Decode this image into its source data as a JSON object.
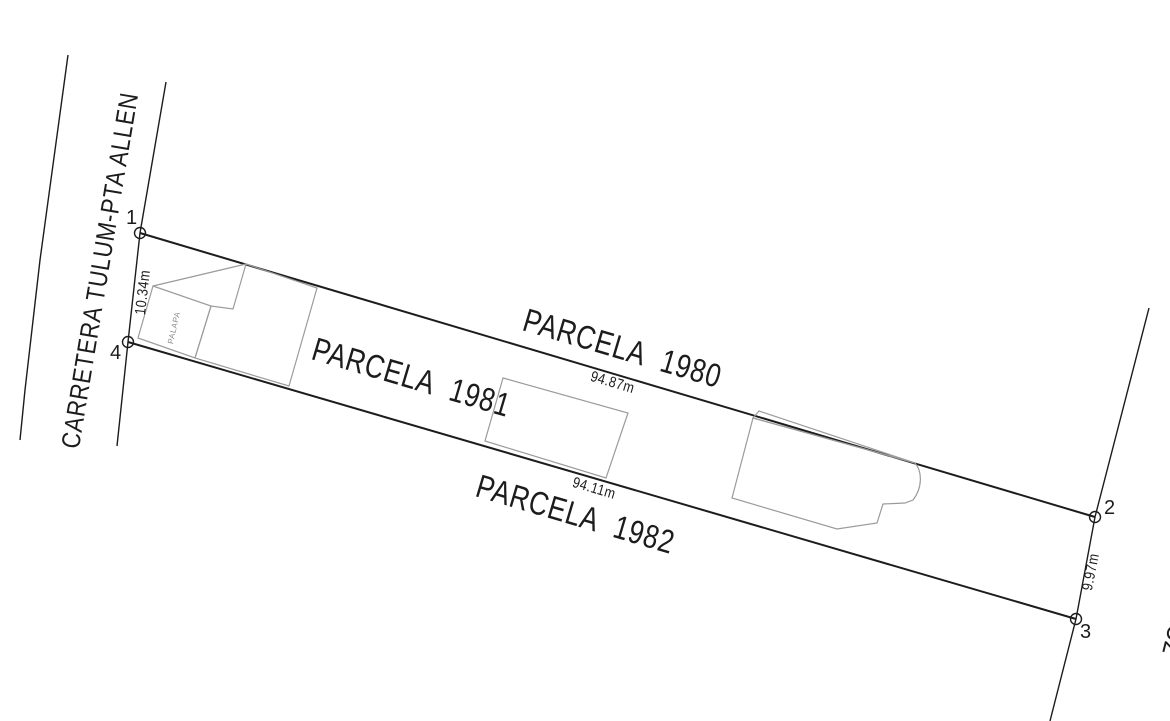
{
  "road": {
    "label": "CARRETERA TULUM-PTA ALLEN"
  },
  "parcels": [
    {
      "id": "parcela-1980",
      "label": "PARCELA 1980"
    },
    {
      "id": "parcela-1981",
      "label": "PARCELA 1981"
    },
    {
      "id": "parcela-1982",
      "label": "PARCELA 1982"
    }
  ],
  "dimensions": {
    "front_width": "10.34m",
    "north_side": "94.87m",
    "south_side": "94.11m",
    "rear_width": "9.97m"
  },
  "corners": {
    "c1": "1",
    "c2": "2",
    "c3": "3",
    "c4": "4"
  },
  "buildings": {
    "palapa_label": "PALAPA"
  },
  "right_edge_partial_label": "ZON",
  "colors": {
    "line": "#1c1c1c",
    "building_outline": "#9b9b9b",
    "background": "#ffffff"
  }
}
